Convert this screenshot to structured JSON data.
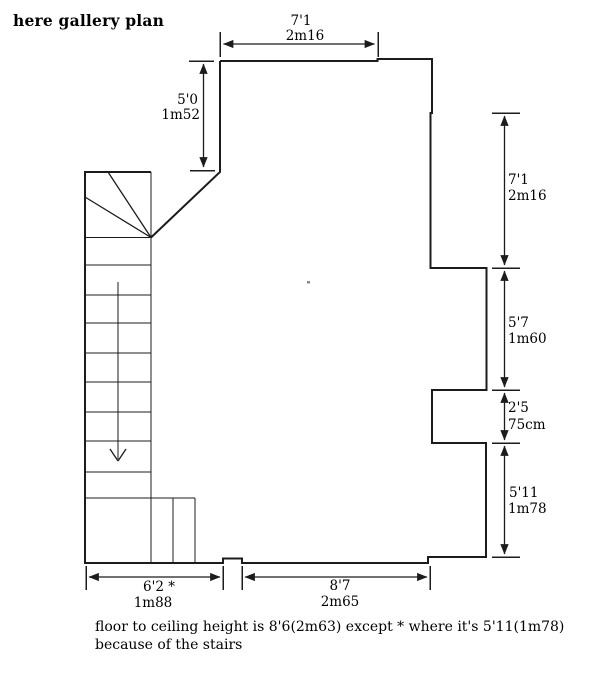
{
  "title": "here gallery plan",
  "plan": {
    "dimensions": {
      "top_width": {
        "imperial": "7'1",
        "metric": "2m16"
      },
      "entry_height": {
        "imperial": "5'0",
        "metric": "1m52"
      },
      "right_upper": {
        "imperial": "7'1",
        "metric": "2m16"
      },
      "right_middle": {
        "imperial": "5'7",
        "metric": "1m60"
      },
      "right_notch": {
        "imperial": "2'5",
        "metric": "75cm"
      },
      "right_lower": {
        "imperial": "5'11",
        "metric": "1m78"
      },
      "bottom_left": {
        "imperial": "6'2 *",
        "metric": "1m88"
      },
      "bottom_right": {
        "imperial": "8'7",
        "metric": "2m65"
      }
    },
    "note_line1": "floor to ceiling height is 8'6(2m63) except * where it's 5'11(1m78)",
    "note_line2": "because of the stairs"
  },
  "colors": {
    "line": "#1c1c1c",
    "text": "#000000",
    "background": "#ffffff"
  }
}
